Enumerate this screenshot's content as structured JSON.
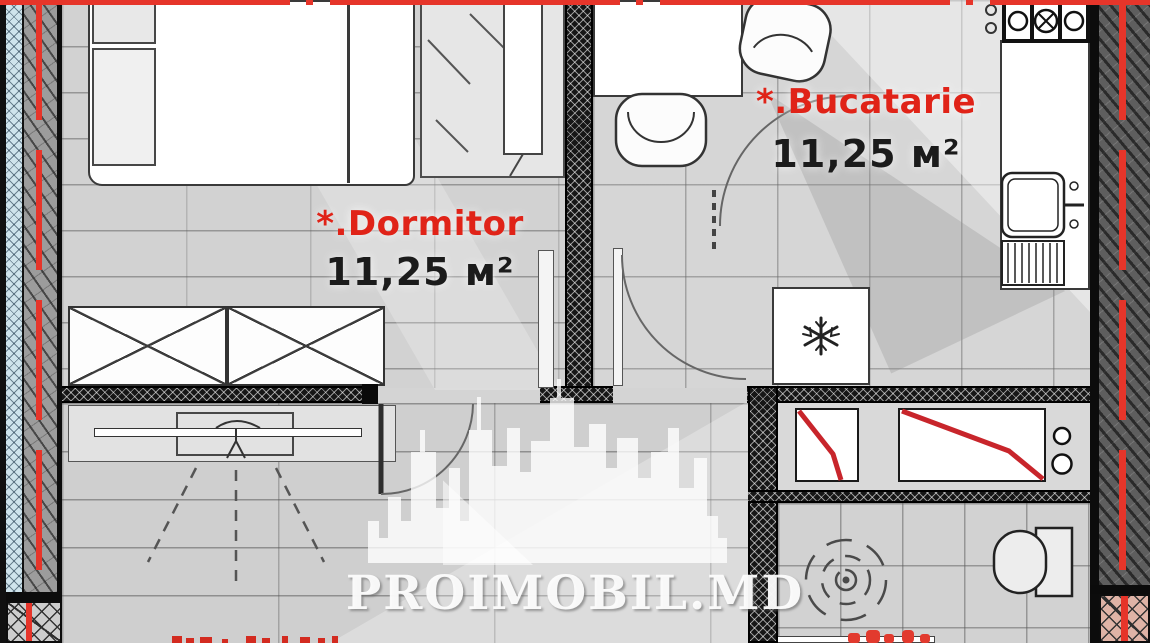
{
  "rooms": [
    {
      "key": "dormitor",
      "label": "*.Dormitor",
      "area": "11,25 м²"
    },
    {
      "key": "bucatarie",
      "label": "*.Bucatarie",
      "area": "11,25 м²"
    }
  ],
  "watermark": {
    "brand": "PROIMOBIL.MD"
  },
  "colors": {
    "label_red": "#e02318",
    "area_text": "#1b1b1b",
    "section_line_red": "#e6352a",
    "wall_dark": "#121212",
    "floor_gray": "#d4d4d4",
    "insulation_blue": "#cfe4ec"
  }
}
